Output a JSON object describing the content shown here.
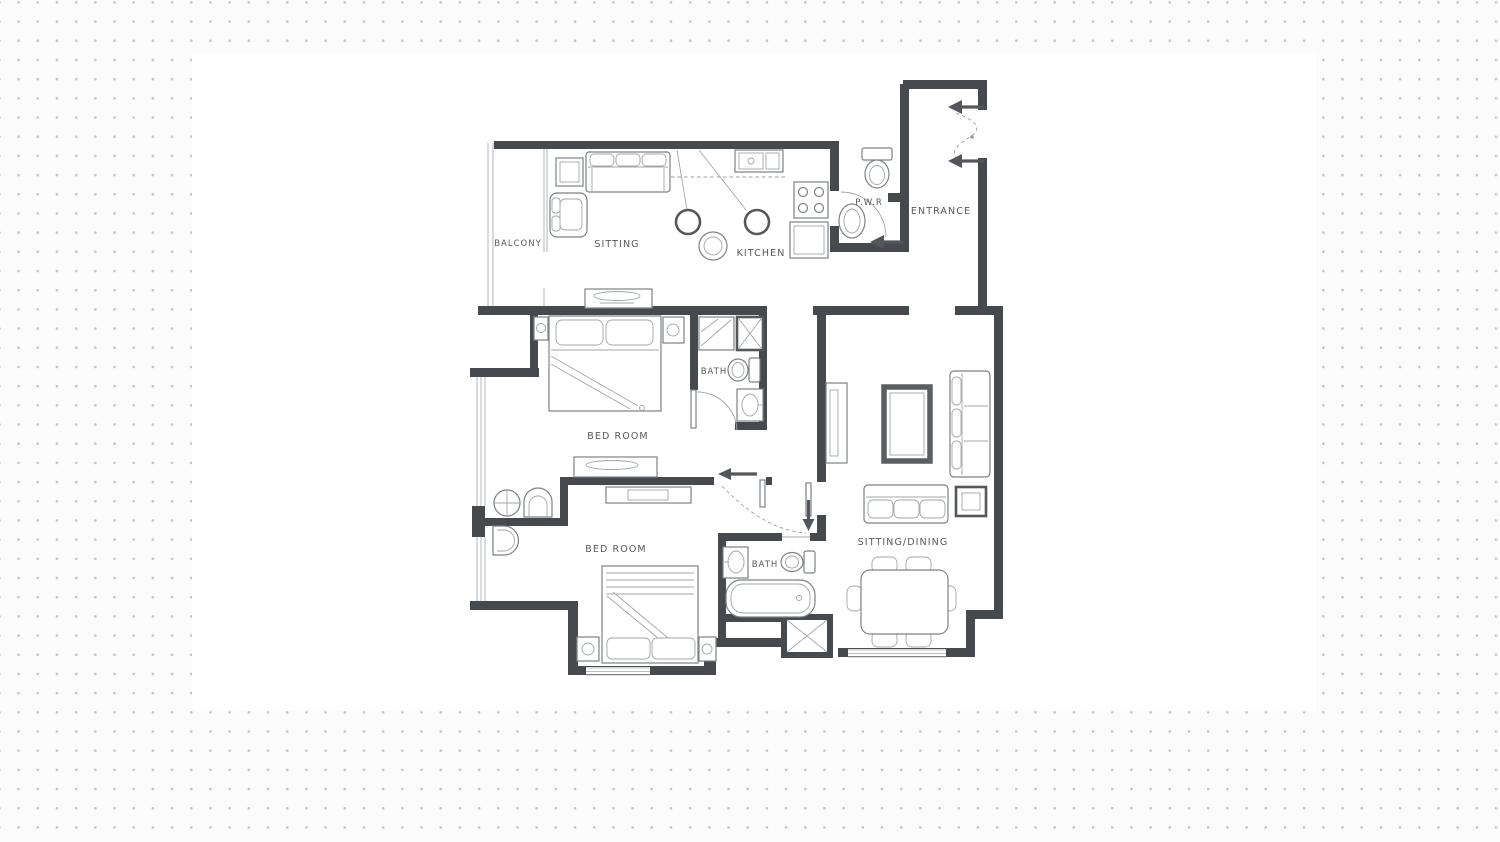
{
  "canvas": {
    "background_color": "#fbfbfb",
    "dot_color": "#c5c6c9",
    "panel_color": "#ffffff"
  },
  "floorplan": {
    "colors": {
      "wall": "#46494d",
      "furniture_line": "#7d8287",
      "light_line": "#a2a6aa",
      "label": "#55595d"
    },
    "rooms": {
      "balcony": {
        "label": "BALCONY"
      },
      "sitting": {
        "label": "SITTING"
      },
      "kitchen": {
        "label": "KITCHEN"
      },
      "pwr": {
        "label": "P.W.R"
      },
      "entrance": {
        "label": "ENTRANCE"
      },
      "bath1": {
        "label": "BATH"
      },
      "bedroom1": {
        "label": "BED ROOM"
      },
      "bedroom2": {
        "label": "BED ROOM"
      },
      "bath2": {
        "label": "BATH"
      },
      "sitting_dining": {
        "label": "SITTING/DINING"
      }
    }
  }
}
